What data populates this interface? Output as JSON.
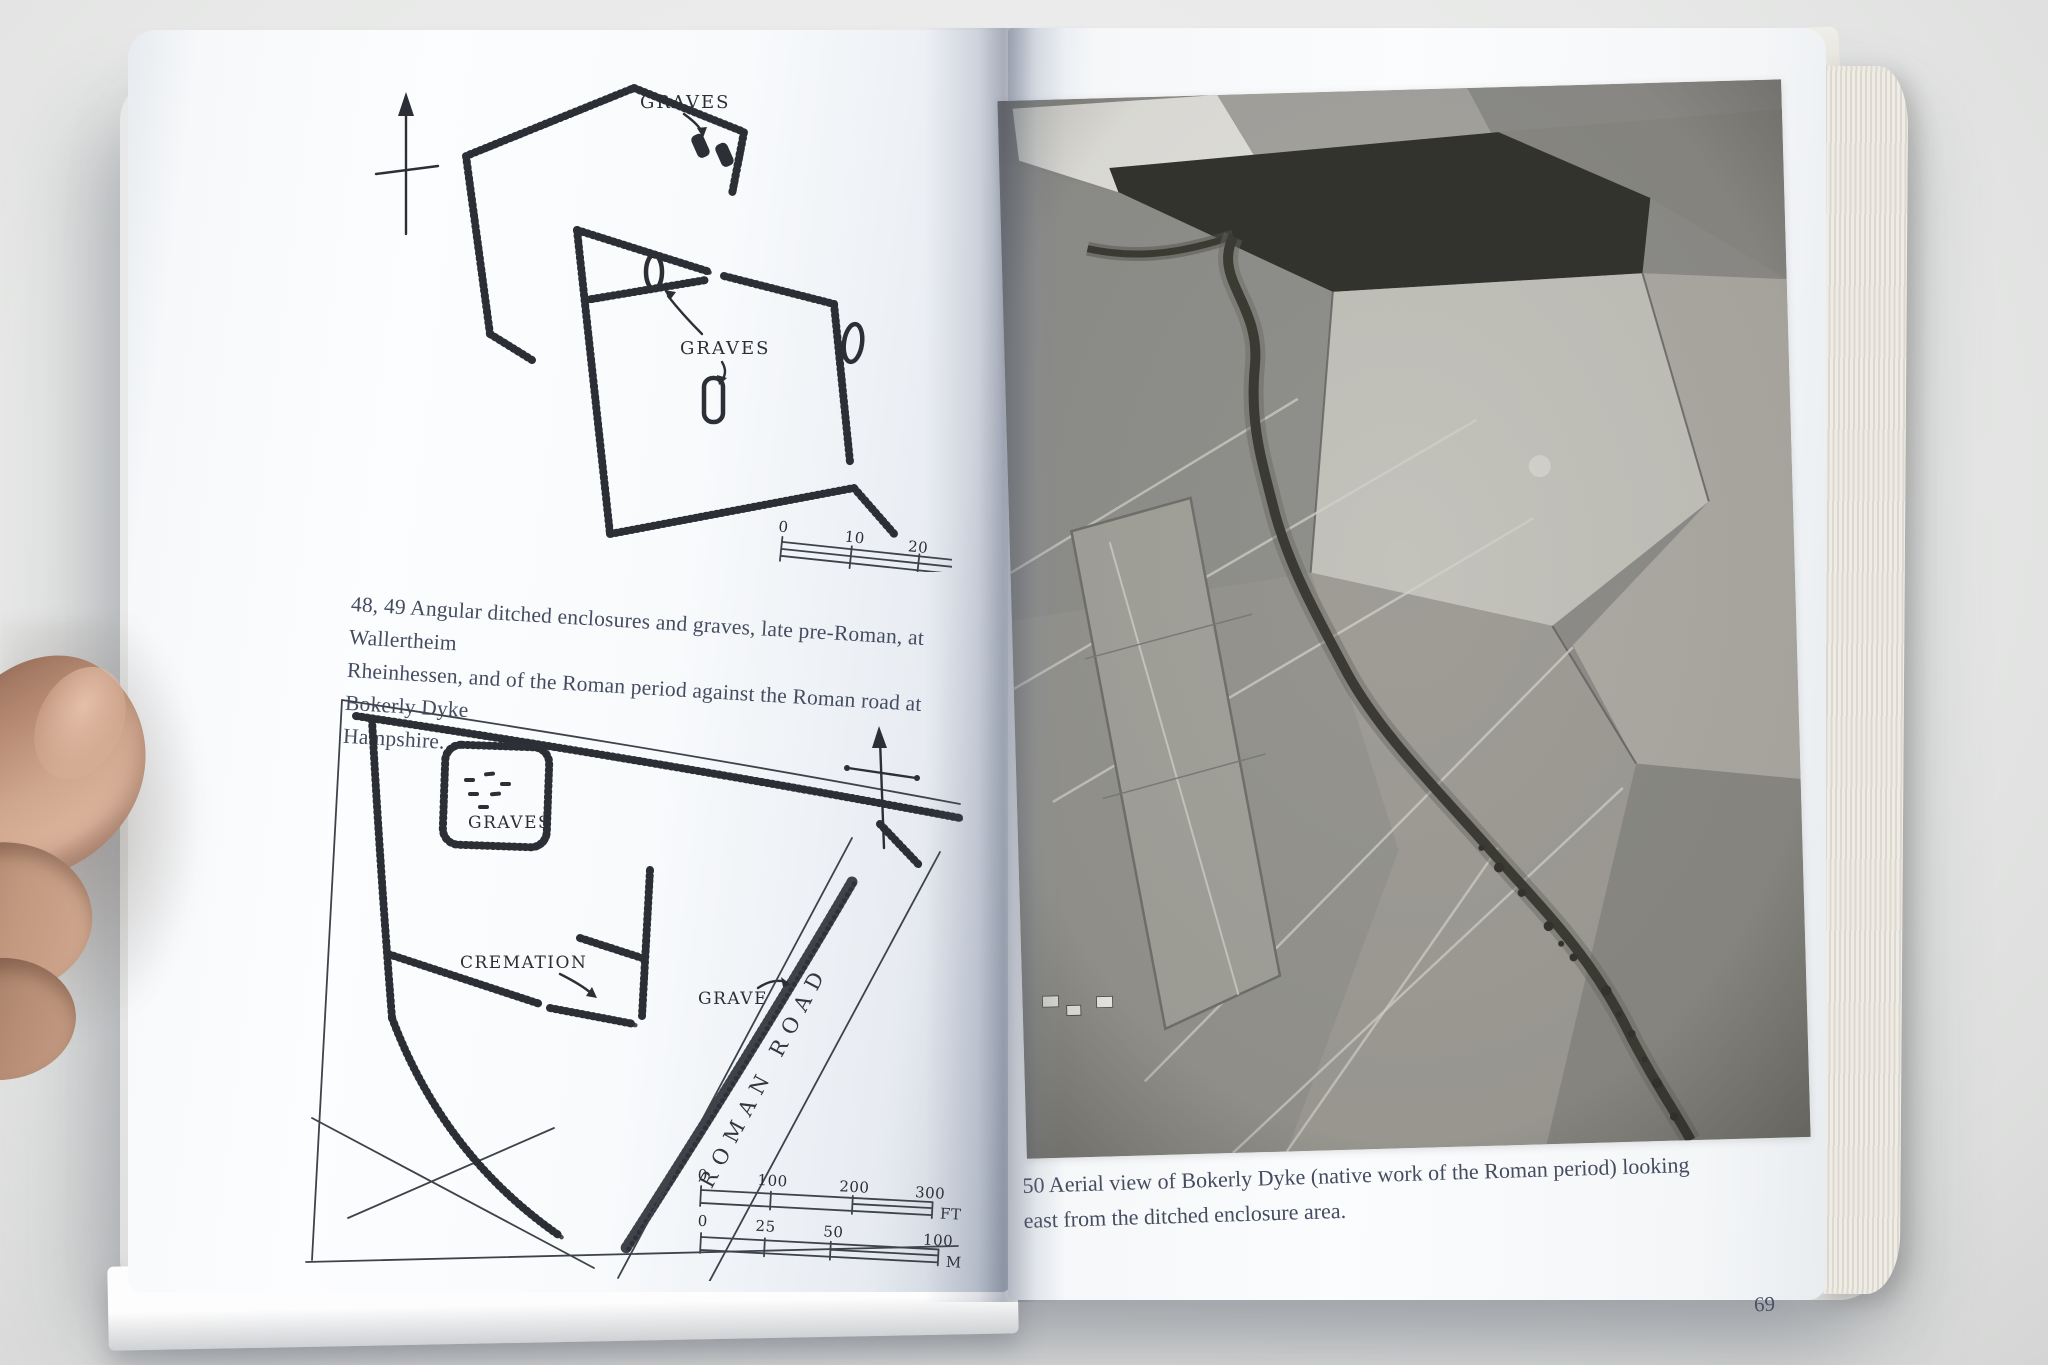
{
  "palette": {
    "background": "#e8e9e8",
    "page": "#fbfcfd",
    "diagram_ink": "#2c2f35",
    "caption_ink": "#454c60",
    "photo_dark": "#33342e",
    "skin_tone": "#c49a82"
  },
  "left_page": {
    "figure_48": {
      "label_graves_top": "GRAVES",
      "label_graves_mid": "GRAVES",
      "scale_ticks": [
        "0",
        "10",
        "20"
      ]
    },
    "caption_lines": [
      "48, 49  Angular ditched enclosures and graves, late pre-Roman, at Wallertheim",
      "Rheinhessen, and of the Roman period against the Roman road at Bokerly Dyke",
      "Hampshire."
    ],
    "figure_49": {
      "label_graves": "GRAVES",
      "label_cremation": "CREMATION",
      "label_grave": "GRAVE",
      "label_road": "ROMAN ROAD",
      "scale_ft": {
        "ticks": [
          "0",
          "100",
          "200",
          "300"
        ],
        "unit": "FT"
      },
      "scale_m": {
        "ticks": [
          "0",
          "25",
          "50",
          "100"
        ],
        "unit": "M"
      }
    }
  },
  "right_page": {
    "caption_lines": [
      "50  Aerial view of Bokerly Dyke (native work of the Roman period) looking",
      "east from the ditched enclosure area."
    ],
    "page_number": "69"
  }
}
